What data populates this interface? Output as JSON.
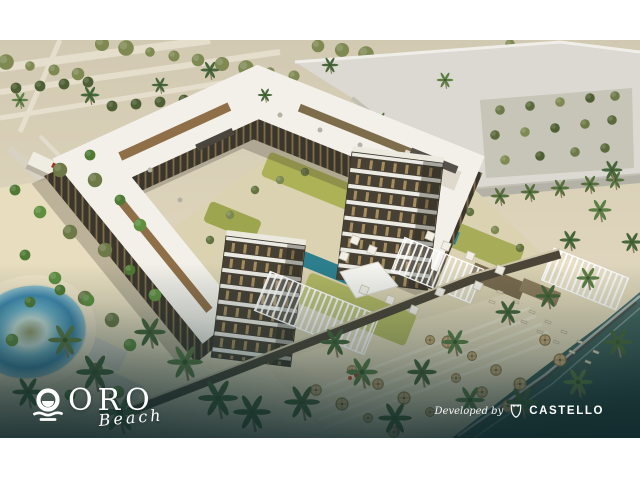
{
  "meta": {
    "kind": "architectural-rendering",
    "description": "Aerial 3D rendering of a beachfront residence: U-shaped white apartment complex with balcony towers, landscaped pool courtyard, circular lagoon pool, palm-lined beach with thatched umbrellas and sea at the lower right."
  },
  "branding": {
    "logo": {
      "title": "ORO",
      "subtitle": "Beach",
      "icon": "sun-over-waves-icon"
    },
    "developer": {
      "prefix": "Developed by",
      "name": "CASTELLO",
      "icon": "castle-shield-icon"
    }
  },
  "palette": {
    "page_background": "#ffffff",
    "text": "#ffffff",
    "vignette_teal": "#15303a",
    "ground_beige": "#d6cdb7",
    "sand": "#e8debf",
    "foliage_green": "#6d7a48",
    "roof_white": "#f2f0e9",
    "facade_dark": "#3b362c",
    "lagoon_blue": "#4f9fc6",
    "sea_teal": "#2e4f4a"
  }
}
